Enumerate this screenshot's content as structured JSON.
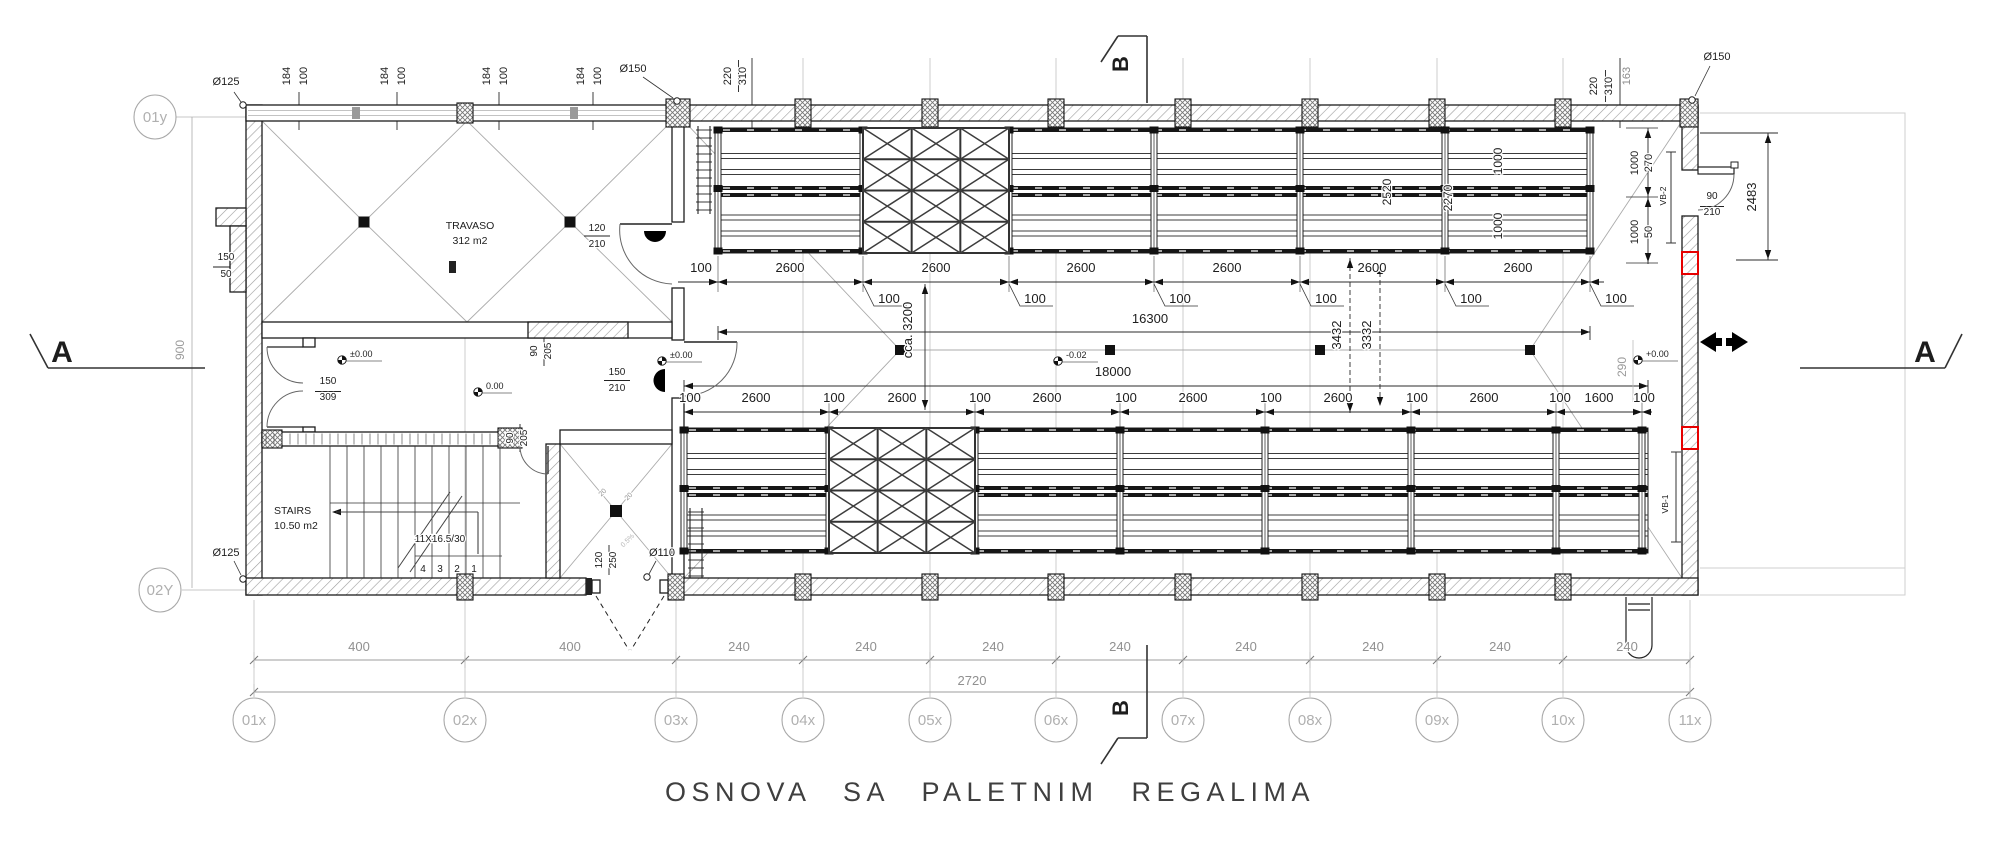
{
  "title": "OSNOVA SA PALETNIM REGALIMA",
  "grid_bubbles": {
    "x_axis": [
      {
        "label": "01x",
        "x": 254
      },
      {
        "label": "02x",
        "x": 465
      },
      {
        "label": "03x",
        "x": 676
      },
      {
        "label": "04x",
        "x": 803
      },
      {
        "label": "05x",
        "x": 930
      },
      {
        "label": "06x",
        "x": 1056
      },
      {
        "label": "07x",
        "x": 1183
      },
      {
        "label": "08x",
        "x": 1310
      },
      {
        "label": "09x",
        "x": 1437
      },
      {
        "label": "10x",
        "x": 1563
      },
      {
        "label": "11x",
        "x": 1690
      }
    ],
    "x_axis_y": 720,
    "y_axis": [
      {
        "label": "01y",
        "x": 155,
        "y": 117
      },
      {
        "label": "02Y",
        "x": 160,
        "y": 590
      }
    ]
  },
  "labels": [
    {
      "n": "drain-label-125-top",
      "t": "Ø125",
      "x": 226,
      "y": 85,
      "s": 11
    },
    {
      "n": "window-dim",
      "t": "184",
      "x": 290,
      "y": 76,
      "s": 11,
      "r": -90
    },
    {
      "n": "window-dim",
      "t": "100",
      "x": 307,
      "y": 76,
      "s": 11,
      "r": -90
    },
    {
      "n": "window-dim",
      "t": "184",
      "x": 388,
      "y": 76,
      "s": 11,
      "r": -90
    },
    {
      "n": "window-dim",
      "t": "100",
      "x": 405,
      "y": 76,
      "s": 11,
      "r": -90
    },
    {
      "n": "window-dim",
      "t": "184",
      "x": 490,
      "y": 76,
      "s": 11,
      "r": -90
    },
    {
      "n": "window-dim",
      "t": "100",
      "x": 507,
      "y": 76,
      "s": 11,
      "r": -90
    },
    {
      "n": "window-dim",
      "t": "184",
      "x": 584,
      "y": 76,
      "s": 11,
      "r": -90
    },
    {
      "n": "window-dim",
      "t": "100",
      "x": 601,
      "y": 76,
      "s": 11,
      "r": -90
    },
    {
      "n": "drain-label-150-left",
      "t": "Ø150",
      "x": 633,
      "y": 72,
      "s": 11
    },
    {
      "n": "wall-dim",
      "t": "220",
      "x": 731,
      "y": 76,
      "s": 11,
      "r": -90
    },
    {
      "n": "wall-dim",
      "t": "310",
      "x": 746,
      "y": 76,
      "s": 11,
      "r": -90
    },
    {
      "n": "wall-dim",
      "t": "220",
      "x": 1597,
      "y": 86,
      "s": 11,
      "r": -90
    },
    {
      "n": "wall-dim",
      "t": "310",
      "x": 1612,
      "y": 86,
      "s": 11,
      "r": -90
    },
    {
      "n": "wall-dim",
      "t": "163",
      "x": 1630,
      "y": 76,
      "s": 11,
      "r": -90,
      "c": "#8c8c8c"
    },
    {
      "n": "drain-label-150-right",
      "t": "Ø150",
      "x": 1717,
      "y": 60,
      "s": 11
    },
    {
      "n": "door-dim",
      "t": "2483",
      "x": 1756,
      "y": 197,
      "s": 13,
      "r": -90
    },
    {
      "n": "door-dim",
      "t": "90",
      "x": 1712,
      "y": 199,
      "s": 10
    },
    {
      "n": "door-dim",
      "t": "210",
      "x": 1712,
      "y": 215,
      "s": 10
    },
    {
      "n": "opening-tag",
      "t": "VB-2",
      "x": 1666,
      "y": 196,
      "s": 8.5,
      "r": -90
    },
    {
      "n": "rack-dim",
      "t": "270",
      "x": 1652,
      "y": 163,
      "s": 11,
      "r": -90
    },
    {
      "n": "rack-dim",
      "t": "50",
      "x": 1652,
      "y": 232,
      "s": 11,
      "r": -90
    },
    {
      "n": "rack-dim",
      "t": "1000",
      "x": 1638,
      "y": 163,
      "s": 11,
      "r": -90
    },
    {
      "n": "rack-dim",
      "t": "1000",
      "x": 1638,
      "y": 232,
      "s": 11,
      "r": -90
    },
    {
      "n": "rack-dim",
      "t": "2520",
      "x": 1391,
      "y": 192,
      "s": 12,
      "r": -90
    },
    {
      "n": "rack-dim",
      "t": "2270",
      "x": 1452,
      "y": 198,
      "s": 12,
      "r": -90
    },
    {
      "n": "rack-dim",
      "t": "1000",
      "x": 1502,
      "y": 161,
      "s": 12,
      "r": -90
    },
    {
      "n": "rack-dim",
      "t": "1000",
      "x": 1502,
      "y": 226,
      "s": 12,
      "r": -90
    },
    {
      "n": "chain-dim",
      "t": "100",
      "x": 701,
      "y": 272
    },
    {
      "n": "chain-dim",
      "t": "2600",
      "x": 790,
      "y": 272
    },
    {
      "n": "chain-dim",
      "t": "2600",
      "x": 936,
      "y": 272
    },
    {
      "n": "chain-dim",
      "t": "2600",
      "x": 1081,
      "y": 272
    },
    {
      "n": "chain-dim",
      "t": "2600",
      "x": 1227,
      "y": 272
    },
    {
      "n": "chain-dim",
      "t": "2600",
      "x": 1372,
      "y": 272
    },
    {
      "n": "chain-dim",
      "t": "2600",
      "x": 1518,
      "y": 272
    },
    {
      "n": "chain-dim",
      "t": "100",
      "x": 889,
      "y": 303
    },
    {
      "n": "chain-dim",
      "t": "100",
      "x": 1035,
      "y": 303
    },
    {
      "n": "chain-dim",
      "t": "100",
      "x": 1180,
      "y": 303
    },
    {
      "n": "chain-dim",
      "t": "100",
      "x": 1326,
      "y": 303
    },
    {
      "n": "chain-dim",
      "t": "100",
      "x": 1471,
      "y": 303
    },
    {
      "n": "chain-dim",
      "t": "100",
      "x": 1616,
      "y": 303
    },
    {
      "n": "total-dim",
      "t": "16300",
      "x": 1150,
      "y": 323
    },
    {
      "n": "aisle-dim",
      "t": "cca. 3200",
      "x": 912,
      "y": 330,
      "r": -90
    },
    {
      "n": "aisle-dim",
      "t": "3432",
      "x": 1341,
      "y": 335,
      "r": -90
    },
    {
      "n": "aisle-dim",
      "t": "3332",
      "x": 1371,
      "y": 335,
      "r": -90
    },
    {
      "n": "total-dim",
      "t": "18000",
      "x": 1113,
      "y": 376
    },
    {
      "n": "grid-dim",
      "t": "290",
      "x": 1626,
      "y": 367,
      "s": 12,
      "r": -90,
      "c": "#9a9a9a"
    },
    {
      "n": "grid-dim",
      "t": "900",
      "x": 184,
      "y": 350,
      "s": 12,
      "r": -90,
      "c": "#9a9a9a"
    },
    {
      "n": "chain-dim",
      "t": "100",
      "x": 690,
      "y": 402
    },
    {
      "n": "chain-dim",
      "t": "2600",
      "x": 756,
      "y": 402
    },
    {
      "n": "chain-dim",
      "t": "100",
      "x": 834,
      "y": 402
    },
    {
      "n": "chain-dim",
      "t": "2600",
      "x": 902,
      "y": 402
    },
    {
      "n": "chain-dim",
      "t": "100",
      "x": 980,
      "y": 402
    },
    {
      "n": "chain-dim",
      "t": "2600",
      "x": 1047,
      "y": 402
    },
    {
      "n": "chain-dim",
      "t": "100",
      "x": 1126,
      "y": 402
    },
    {
      "n": "chain-dim",
      "t": "2600",
      "x": 1193,
      "y": 402
    },
    {
      "n": "chain-dim",
      "t": "100",
      "x": 1271,
      "y": 402
    },
    {
      "n": "chain-dim",
      "t": "2600",
      "x": 1338,
      "y": 402
    },
    {
      "n": "chain-dim",
      "t": "100",
      "x": 1417,
      "y": 402
    },
    {
      "n": "chain-dim",
      "t": "2600",
      "x": 1484,
      "y": 402
    },
    {
      "n": "chain-dim",
      "t": "100",
      "x": 1560,
      "y": 402
    },
    {
      "n": "chain-dim",
      "t": "1600",
      "x": 1599,
      "y": 402
    },
    {
      "n": "chain-dim",
      "t": "100",
      "x": 1644,
      "y": 402
    },
    {
      "n": "room-travaso-name",
      "t": "TRAVASO",
      "x": 470,
      "y": 229,
      "s": 10.5
    },
    {
      "n": "room-travaso-area",
      "t": "312 m2",
      "x": 470,
      "y": 244,
      "s": 10.5
    },
    {
      "n": "room-stairs-name",
      "t": "STAIRS",
      "x": 274,
      "y": 514,
      "s": 10.5,
      "a": "start"
    },
    {
      "n": "room-stairs-area",
      "t": "10.50 m2",
      "x": 274,
      "y": 529,
      "s": 10.5,
      "a": "start"
    },
    {
      "n": "stairs-note",
      "t": "11X16.5/30",
      "x": 440,
      "y": 542,
      "s": 10
    },
    {
      "n": "step-number",
      "t": "4",
      "x": 423,
      "y": 572,
      "s": 10
    },
    {
      "n": "step-number",
      "t": "3",
      "x": 440,
      "y": 572,
      "s": 10
    },
    {
      "n": "step-number",
      "t": "2",
      "x": 457,
      "y": 572,
      "s": 10
    },
    {
      "n": "step-number",
      "t": "1",
      "x": 474,
      "y": 572,
      "s": 10
    },
    {
      "n": "chimney-dim",
      "t": "150",
      "x": 226,
      "y": 260,
      "s": 10
    },
    {
      "n": "chimney-dim",
      "t": "50",
      "x": 226,
      "y": 277,
      "s": 10
    },
    {
      "n": "door-dim",
      "t": "120",
      "x": 597,
      "y": 231,
      "s": 10
    },
    {
      "n": "door-dim",
      "t": "210",
      "x": 597,
      "y": 247,
      "s": 10
    },
    {
      "n": "door-dim",
      "t": "90",
      "x": 537,
      "y": 351,
      "s": 10,
      "r": -90
    },
    {
      "n": "door-dim",
      "t": "205",
      "x": 551,
      "y": 351,
      "s": 10,
      "r": -90
    },
    {
      "n": "door-dim",
      "t": "150",
      "x": 617,
      "y": 375,
      "s": 10
    },
    {
      "n": "door-dim",
      "t": "210",
      "x": 617,
      "y": 391,
      "s": 10
    },
    {
      "n": "door-dim",
      "t": "150",
      "x": 328,
      "y": 384,
      "s": 10
    },
    {
      "n": "door-dim",
      "t": "309",
      "x": 328,
      "y": 400,
      "s": 10
    },
    {
      "n": "door-dim",
      "t": "90",
      "x": 513,
      "y": 438,
      "s": 10,
      "r": -90
    },
    {
      "n": "door-dim",
      "t": "205",
      "x": 527,
      "y": 438,
      "s": 10,
      "r": -90
    },
    {
      "n": "door-dim",
      "t": "120",
      "x": 602,
      "y": 560,
      "s": 10,
      "r": -90
    },
    {
      "n": "door-dim",
      "t": "250",
      "x": 616,
      "y": 560,
      "s": 10,
      "r": -90
    },
    {
      "n": "drain-label-110",
      "t": "Ø110",
      "x": 662,
      "y": 556,
      "s": 11
    },
    {
      "n": "drain-label-125-bottom",
      "t": "Ø125",
      "x": 226,
      "y": 556,
      "s": 11
    },
    {
      "n": "opening-tag",
      "t": "VB-1",
      "x": 1668,
      "y": 504,
      "s": 8.5,
      "r": -90
    },
    {
      "n": "shaft-dim",
      "t": "20",
      "x": 604,
      "y": 494,
      "s": 7,
      "r": -45,
      "c": "#909090"
    },
    {
      "n": "shaft-dim",
      "t": "20",
      "x": 630,
      "y": 498,
      "s": 7,
      "r": -45,
      "c": "#909090"
    },
    {
      "n": "slope-label",
      "t": "0.5%",
      "x": 629,
      "y": 542,
      "s": 7,
      "r": -45,
      "c": "#b5b5b5"
    },
    {
      "n": "level-label",
      "t": "±0.00",
      "x": 350,
      "y": 357,
      "s": 9,
      "a": "start"
    },
    {
      "n": "level-label",
      "t": "±0.00",
      "x": 670,
      "y": 358,
      "s": 9,
      "a": "start"
    },
    {
      "n": "level-label",
      "t": "0.00",
      "x": 486,
      "y": 389,
      "s": 9,
      "a": "start"
    },
    {
      "n": "level-label",
      "t": "-0.02",
      "x": 1066,
      "y": 358,
      "s": 9,
      "a": "start"
    },
    {
      "n": "level-label",
      "t": "+0.00",
      "x": 1646,
      "y": 357,
      "s": 9,
      "a": "start"
    },
    {
      "n": "grid-dim",
      "t": "400",
      "x": 359,
      "y": 651,
      "c": "#909090"
    },
    {
      "n": "grid-dim",
      "t": "400",
      "x": 570,
      "y": 651,
      "c": "#909090"
    },
    {
      "n": "grid-dim",
      "t": "240",
      "x": 739,
      "y": 651,
      "c": "#909090"
    },
    {
      "n": "grid-dim",
      "t": "240",
      "x": 866,
      "y": 651,
      "c": "#909090"
    },
    {
      "n": "grid-dim",
      "t": "240",
      "x": 993,
      "y": 651,
      "c": "#909090"
    },
    {
      "n": "grid-dim",
      "t": "240",
      "x": 1120,
      "y": 651,
      "c": "#909090"
    },
    {
      "n": "grid-dim",
      "t": "240",
      "x": 1246,
      "y": 651,
      "c": "#909090"
    },
    {
      "n": "grid-dim",
      "t": "240",
      "x": 1373,
      "y": 651,
      "c": "#909090"
    },
    {
      "n": "grid-dim",
      "t": "240",
      "x": 1500,
      "y": 651,
      "c": "#909090"
    },
    {
      "n": "grid-dim",
      "t": "240",
      "x": 1627,
      "y": 651,
      "c": "#909090"
    },
    {
      "n": "grid-total-dim",
      "t": "2720",
      "x": 972,
      "y": 685,
      "c": "#909090"
    },
    {
      "n": "section-letter-a-left",
      "t": "A",
      "x": 62,
      "y": 362,
      "s": 30,
      "w": "600"
    },
    {
      "n": "section-letter-a-right",
      "t": "A",
      "x": 1925,
      "y": 362,
      "s": 30,
      "w": "600"
    },
    {
      "n": "section-letter-b-top",
      "t": "B",
      "x": 1128,
      "y": 64,
      "s": 22,
      "r": -90,
      "w": "700"
    },
    {
      "n": "section-letter-b-bottom",
      "t": "B",
      "x": 1128,
      "y": 708,
      "s": 22,
      "r": -90,
      "w": "700"
    }
  ]
}
